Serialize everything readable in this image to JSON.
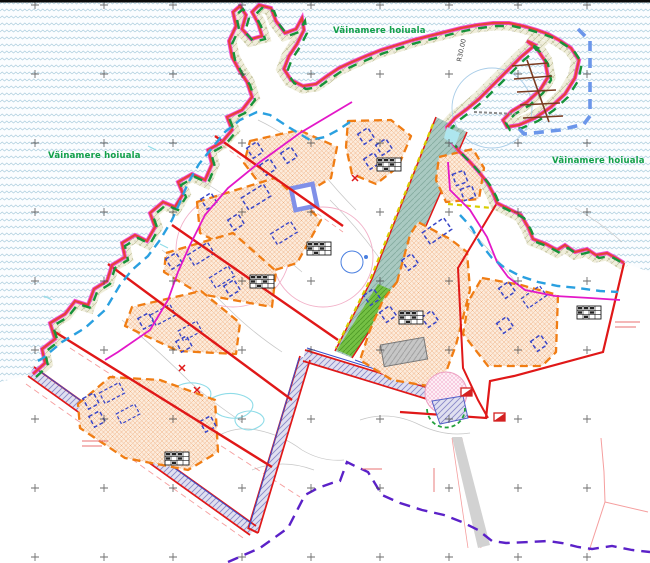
{
  "map": {
    "title": "Detailplaneering — rannaala krundijaotus- ja hoonestusplaan",
    "labels": {
      "protected_area_left": "Väinamere hoiuala",
      "protected_area_top": "Väinamere hoiuala",
      "protected_area_right": "Väinamere hoiuala",
      "radius_label": "R30.00"
    },
    "legend_semantics": {
      "sea_pattern": "water (Väinamere)",
      "orange_dashed_polygon": "building envelope (hoonestusala)",
      "blue_dashed_rect": "planned building",
      "red_thick_line": "planned plot boundary",
      "green_dashed_line": "protected area boundary",
      "purple_hatch_band": "planned road",
      "blue_thick_dashed": "harbour water area",
      "brown_comb": "pier / jetty",
      "gray_rect": "existing building"
    },
    "colors": {
      "water_wave": "#aecfdf",
      "coast_red": "#e8403a",
      "magenta_fringe": "#ee30d0",
      "boundary_red": "#e01818",
      "envelope_orange": "#f07d14",
      "building_blue": "#3a46c8",
      "protected_green": "#18923a",
      "road_hatch": "#8888c8",
      "harbour_blue": "#6b96ea",
      "pier_brown": "#7a3b20",
      "teal_road": "#a8c8c0",
      "green_road": "#74c044",
      "yellow_marking": "#d8ce00",
      "cadastral_pink": "#f59e9e",
      "deep_purple_dash": "#5b21c8",
      "label_green": "#13a04a"
    }
  }
}
